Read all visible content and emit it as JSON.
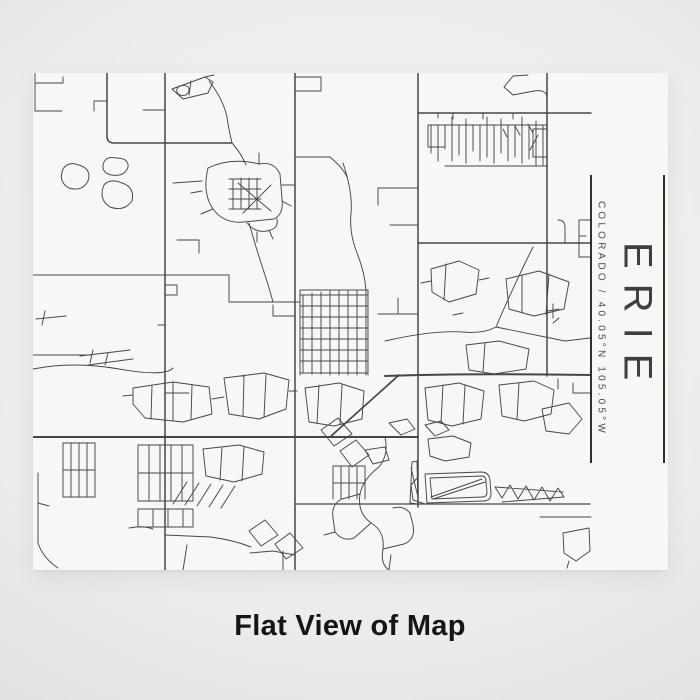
{
  "page": {
    "caption": "Flat View of Map"
  },
  "poster": {
    "title": "ERIE",
    "subtitle": "COLORADO / 40.05°N 105.05°W"
  },
  "colors": {
    "road": "#474747",
    "rule": "#2d2f31",
    "title-text": "#3c4043",
    "subtitle-text": "#4a4d50",
    "poster-bg": "#f7f7f6",
    "page-bg-center": "#f4f4f3",
    "page-bg-edge": "#d8d8d7",
    "caption-text": "#151515"
  }
}
